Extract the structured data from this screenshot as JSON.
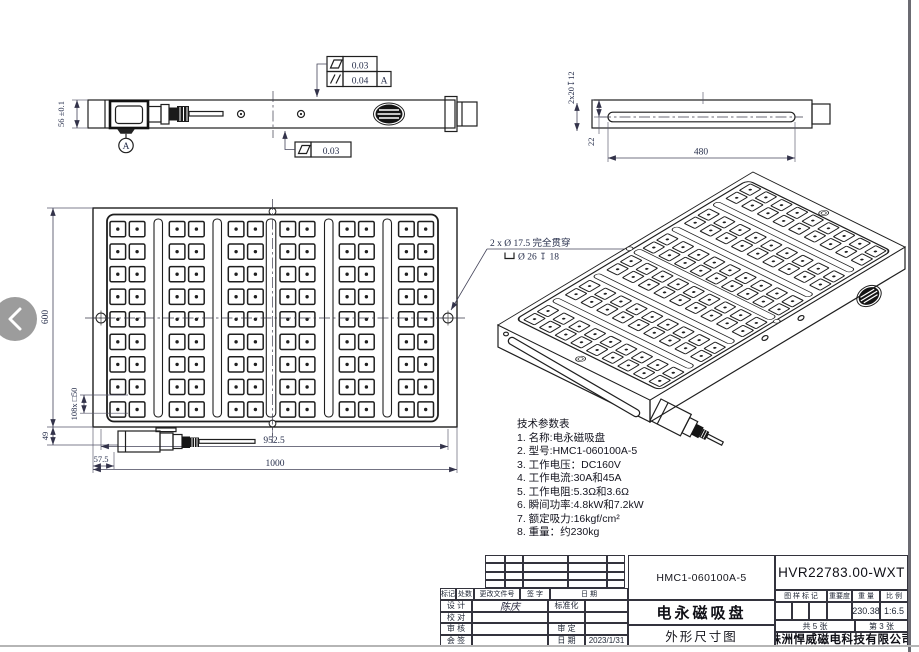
{
  "viewer": {
    "prev_icon": "chevron-left"
  },
  "side_view_left": {
    "height_dim": "56 ±0.1",
    "datum_label": "A",
    "fcf_flatness_value": "0.03",
    "fcf_parallel_value": "0.04",
    "fcf_parallel_datum": "A",
    "fcf_bottom_flatness_value": "0.03"
  },
  "side_view_right": {
    "slot_callout": "2x20↧12",
    "top_offset_dim": "22",
    "slot_length_dim": "480"
  },
  "front_view": {
    "width_dim": "1000",
    "height_dim": "600",
    "hole_span_dim": "952.5",
    "pole_dim": "108x □50",
    "connector_height_dim": "49",
    "connector_offset_dim": "57.5",
    "hole_callout_line1": "2 x Ø 17.5 完全贯穿",
    "hole_callout_line2": "Ø 26 ↧ 18",
    "grid": {
      "rows": 9,
      "cols": 12,
      "pairs": 6
    }
  },
  "tech_params": {
    "lines": [
      "技术参数表",
      "1. 名称:电永磁吸盘",
      "2. 型号:HMC1-060100A-5",
      "3. 工作电压：DC160V",
      "4. 工作电流:30A和45A",
      "5. 工作电阻:5.3Ω和3.6Ω",
      "6. 瞬间功率:4.8kW和7.2kW",
      "7. 额定吸力:16kgf/cm²",
      "8. 重量：约230kg"
    ]
  },
  "title_block": {
    "revision_header": [
      "标记",
      "处数",
      "更改文件号",
      "签 字",
      "日 期"
    ],
    "rows": [
      {
        "label": "设 计",
        "value": "陈庆",
        "label2": "标准化",
        "value2": ""
      },
      {
        "label": "校 对",
        "value": "",
        "label2": "",
        "value2": ""
      },
      {
        "label": "审 核",
        "value": "",
        "label2": "审 定",
        "value2": ""
      },
      {
        "label": "会 签",
        "value": "",
        "label2": "日 期",
        "value2": "2023/1/31"
      }
    ],
    "model": "HMC1-060100A-5",
    "product_name": "电永磁吸盘",
    "drawing_type": "外形尺寸图",
    "drawing_no": "HVR22783.00-WXT",
    "stamp_headers": [
      "图 样 标 记",
      "重要度",
      "重 量",
      "比 例"
    ],
    "weight_value": "230.38",
    "scale_value": "1:6.5",
    "sheet_total": "共 5 张",
    "sheet_no": "第 3 张",
    "company": "株洲悍威磁电科技有限公司"
  },
  "colors": {
    "line": "#1f1f1f",
    "dim_text": "#262e4b",
    "viewer_button": "#9c9c9c"
  }
}
